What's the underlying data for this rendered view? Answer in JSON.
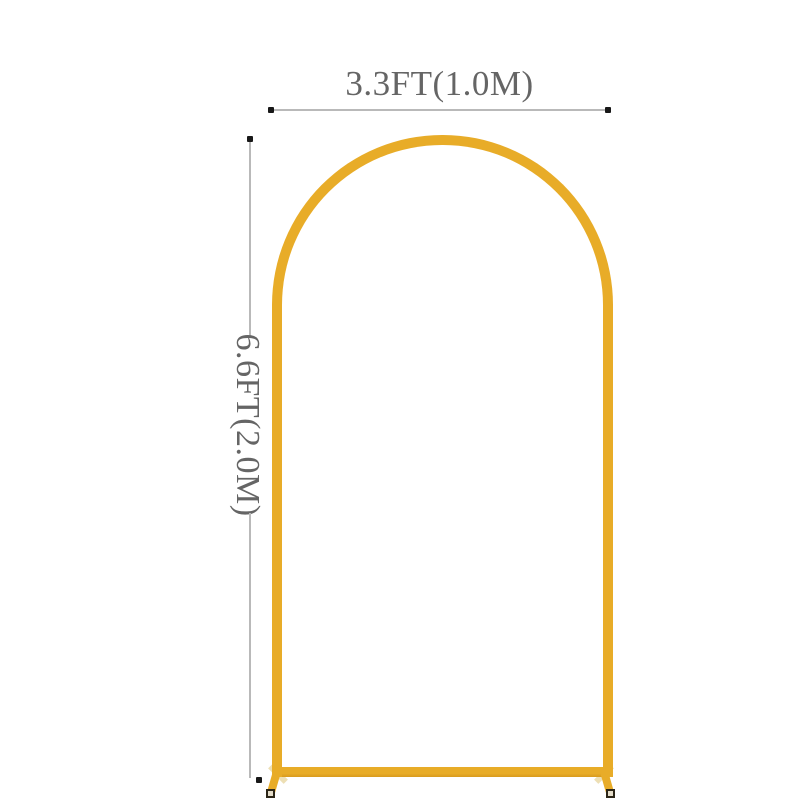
{
  "diagram": {
    "width_label": "3.3FT(1.0M)",
    "height_label": "6.6FT(2.0M)",
    "colors": {
      "background": "#FFFFFF",
      "arch_gold": "#E8AC28",
      "arch_gold_dark": "#D89B1E",
      "rear_foot": "#EDDFB4",
      "foot_cap_fill": "#E4DCC9",
      "foot_cap_border": "#2B2517",
      "dim_line": "#B9B9B9",
      "dim_dot": "#181818",
      "label_text": "#656565"
    }
  }
}
